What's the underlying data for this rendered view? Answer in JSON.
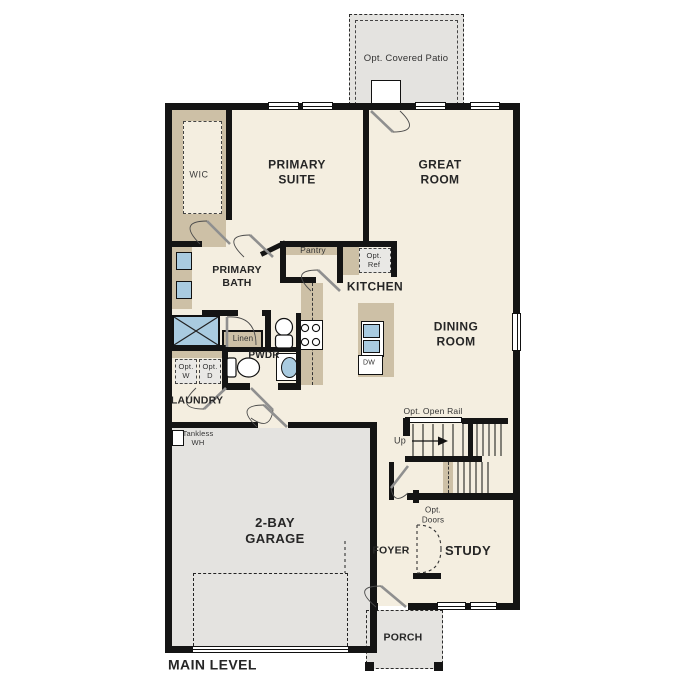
{
  "title": "MAIN LEVEL",
  "colors": {
    "floor": "#f4eee0",
    "concrete": "#e4e3e0",
    "wall": "#141414",
    "cabinet": "#cdc0a6",
    "fixture": "#a9cbe0",
    "door_panel": "#8f8f8f"
  },
  "labels": {
    "patio": "Opt. Covered Patio",
    "wic": "WIC",
    "primary_suite": "PRIMARY\nSUITE",
    "great_room": "GREAT\nROOM",
    "pantry": "Pantry",
    "opt_ref": "Opt.\nRef",
    "kitchen": "KITCHEN",
    "primary_bath": "PRIMARY\nBATH",
    "dining_room": "DINING\nROOM",
    "linen": "Linen",
    "pwdr": "PWDR",
    "opt_w": "Opt.\nW",
    "opt_d": "Opt.\nD",
    "laundry": "LAUNDRY",
    "tankless_wh": "Tankless\nWH",
    "opt_open_rail": "Opt. Open Rail",
    "up": "Up",
    "garage": "2-BAY\nGARAGE",
    "foyer": "FOYER",
    "opt_doors": "Opt.\nDoors",
    "study": "STUDY",
    "porch": "PORCH",
    "dw": "DW",
    "main_level": "MAIN LEVEL"
  }
}
